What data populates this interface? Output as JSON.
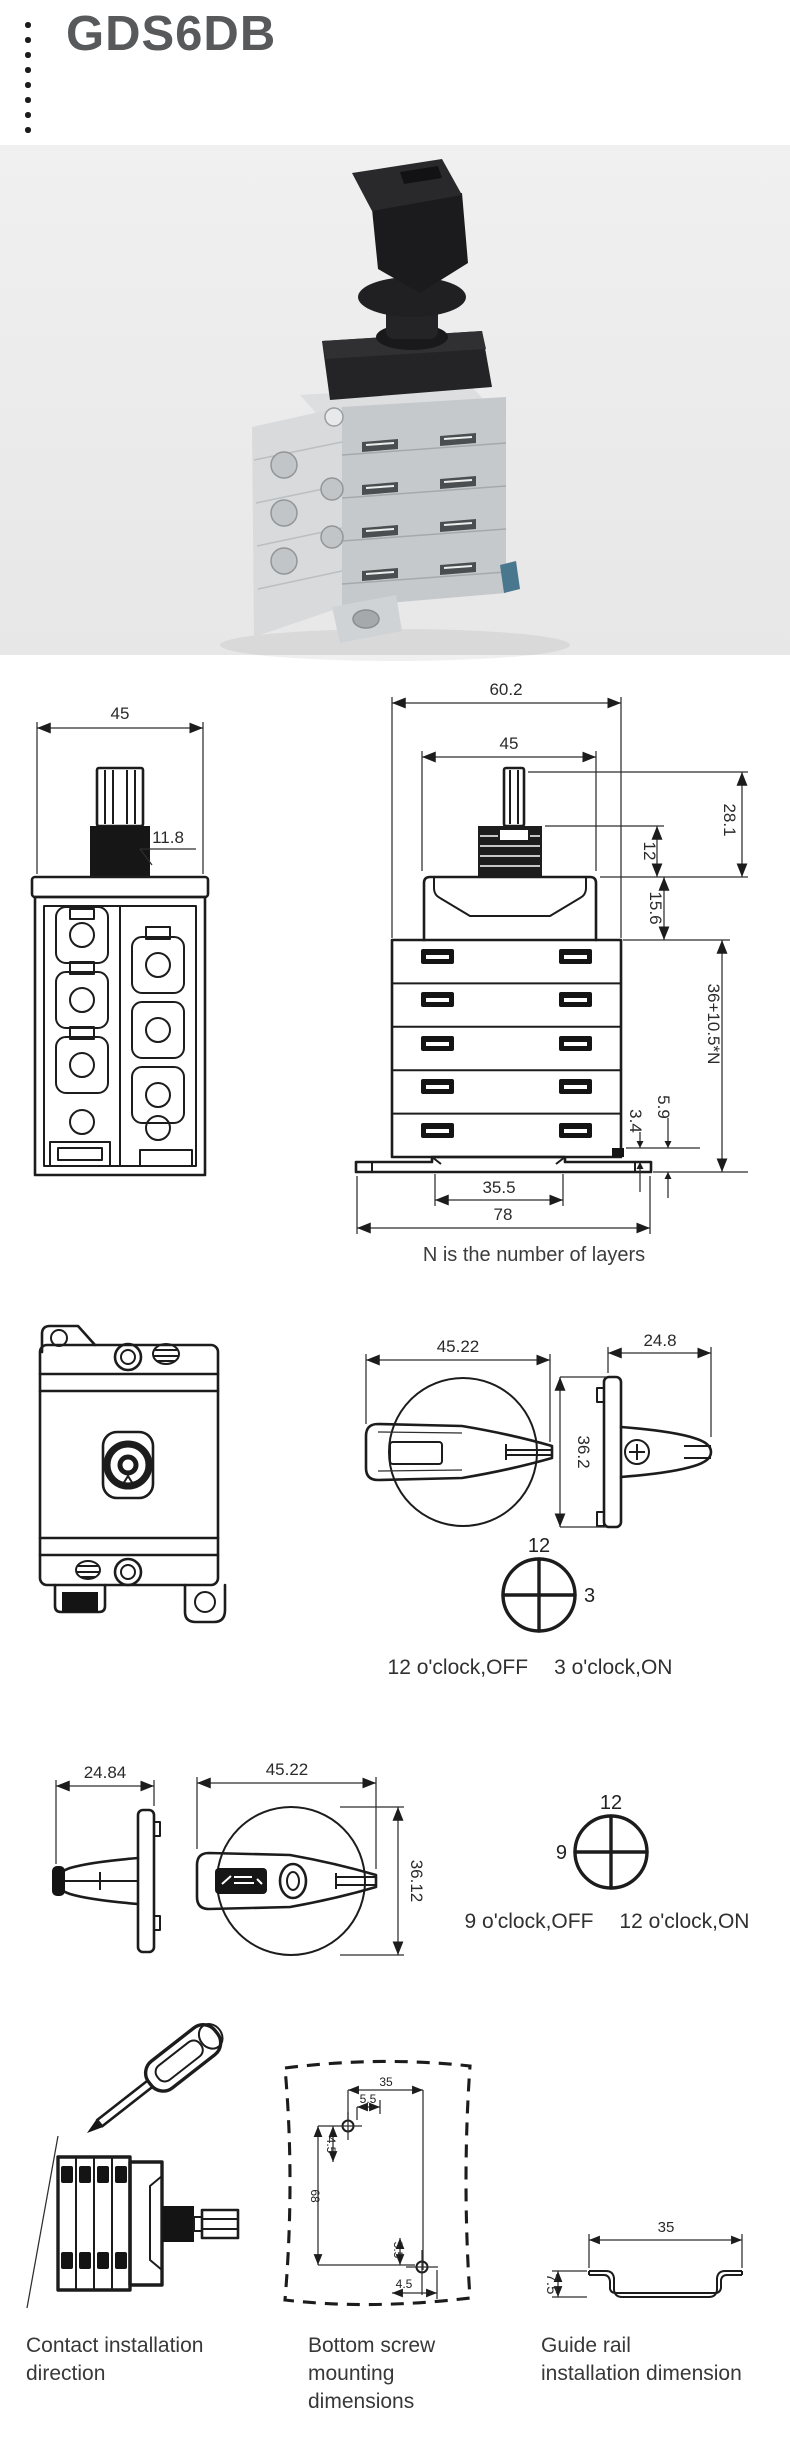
{
  "title": "GDS6DB",
  "dims": {
    "front_width": "45",
    "shaft": "11.8",
    "overall_width": "60.2",
    "body_width": "45",
    "shaft_total": "28.1",
    "thread": "12",
    "head": "15.6",
    "stack": "36+10.5*N",
    "clip_gap": "3.4",
    "foot": "5.9",
    "rail_slot": "35.5",
    "base": "78"
  },
  "note": "N is the number of layers",
  "handle_right": {
    "front_width": "45.22",
    "side_width": "24.8",
    "height": "36.2",
    "clock_top": "12",
    "clock_side": "3",
    "off": "12 o'clock,OFF",
    "on": "3 o'clock,ON"
  },
  "handle_left": {
    "side_width": "24.84",
    "front_width": "45.22",
    "height": "36.12",
    "clock_top": "12",
    "clock_side": "9",
    "off": "9 o'clock,OFF",
    "on": "12 o'clock,ON"
  },
  "mounting": {
    "screw_width": "35",
    "screw_top_offset": "5.5",
    "screw_top_inset": "4.5",
    "screw_height": "68",
    "screw_bottom_offset": "5.5",
    "screw_bottom_inset": "4.5",
    "rail_width": "35",
    "rail_height": "7.5"
  },
  "captions": {
    "contact_1": "Contact installation",
    "contact_2": "direction",
    "screw_1": "Bottom screw",
    "screw_2": "mounting",
    "screw_3": "dimensions",
    "rail_1": "Guide rail",
    "rail_2": "installation dimension"
  }
}
